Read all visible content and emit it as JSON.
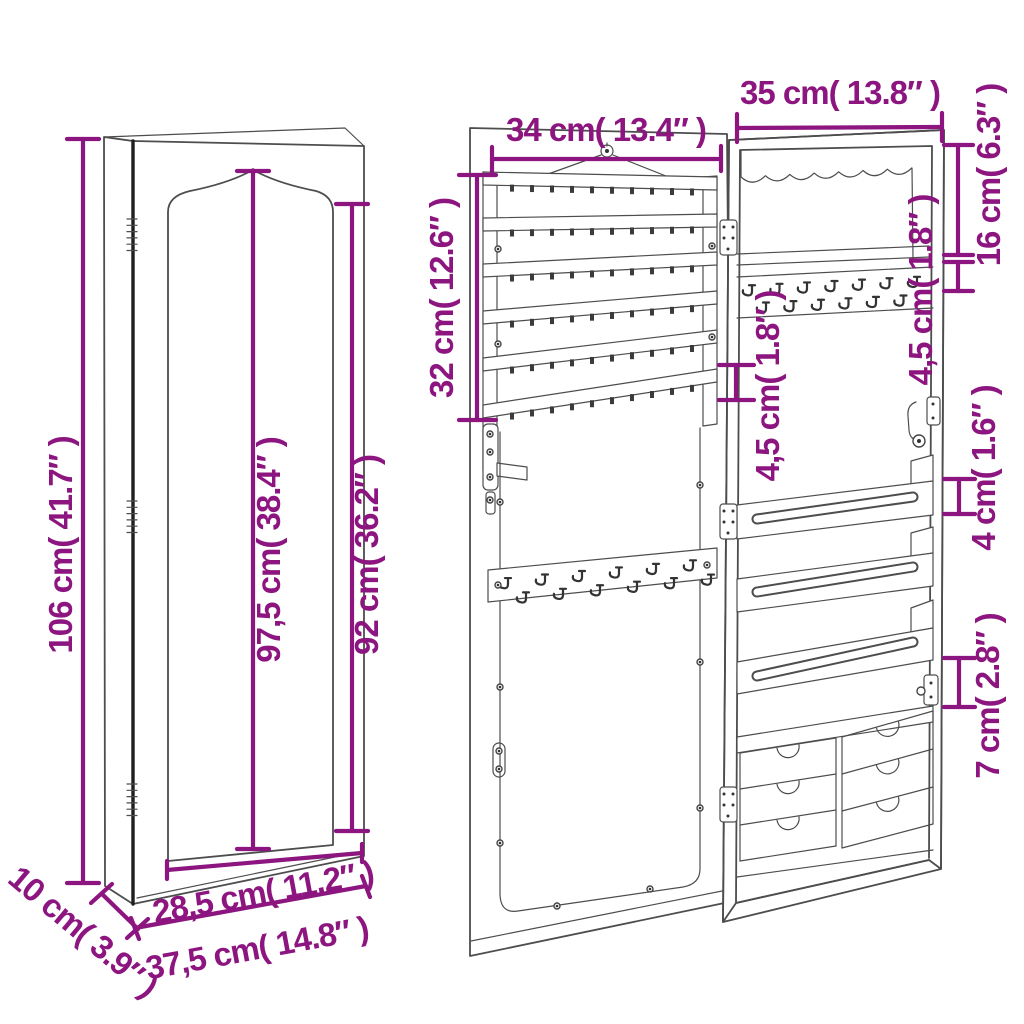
{
  "colors": {
    "accent": "#8D1580",
    "line": "#4d4d4d",
    "line_dark": "#1f1f1f",
    "background": "#ffffff"
  },
  "dimensions": {
    "overall_height": "106 cm( 41.7″ )",
    "mirror_height": "97,5 cm( 38.4″ )",
    "front_height": "92 cm( 36.2″ )",
    "depth": "10 cm( 3.9″ )",
    "mirror_width": "28,5 cm( 11.2″ )",
    "overall_width": "37,5 cm( 14.8″ )",
    "door_rack_width": "34 cm( 13.4″ )",
    "door_rack_height": "32 cm( 12.6″ )",
    "door_rack_spacing": "4,5 cm( 1.8″ )",
    "cabinet_width": "35 cm( 13.8″ )",
    "top_compartment_height": "16 cm( 6.3″ )",
    "shelf_clearance": "4,5 cm( 1.8″ )",
    "tray_height": "4 cm( 1.6″ )",
    "drawer_clearance": "7 cm( 2.8″ )"
  }
}
